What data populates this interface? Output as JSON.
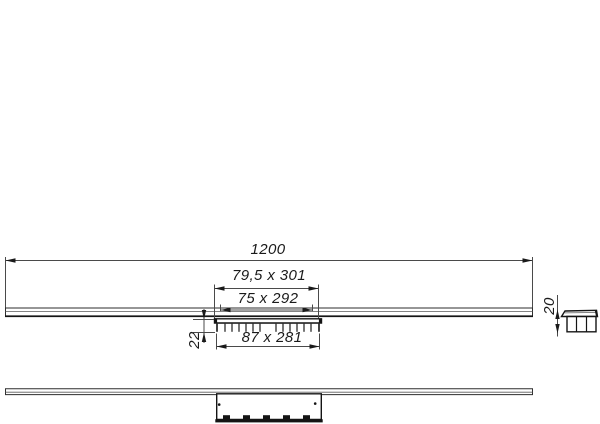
{
  "drawing": {
    "labels": {
      "overall_length": "1200",
      "cover_plate_size": "79,5 x 301",
      "insert_size": "75 x 292",
      "body_size": "87 x 281",
      "trap_depth": "22",
      "profile_height": "20"
    },
    "colors": {
      "background": "#ffffff",
      "line": "#3d3d3d",
      "line_dark": "#141414"
    }
  }
}
